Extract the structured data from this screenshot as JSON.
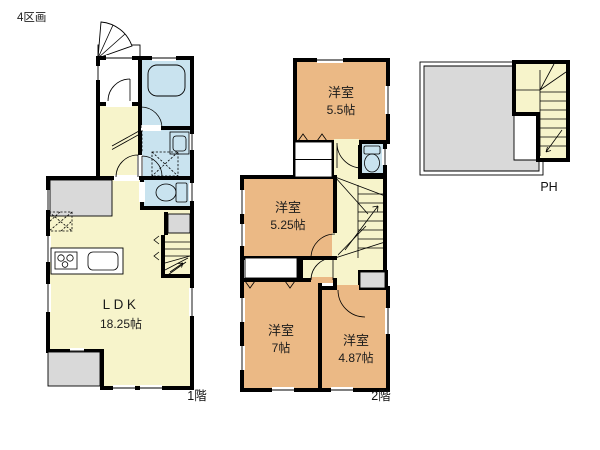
{
  "title": "4区画",
  "floor1": {
    "label": "1階",
    "ldk": {
      "name": "LDK",
      "size": "18.25帖"
    }
  },
  "floor2": {
    "label": "2階",
    "rooms": [
      {
        "name": "洋室",
        "size": "5.5帖"
      },
      {
        "name": "洋室",
        "size": "5.25帖"
      },
      {
        "name": "洋室",
        "size": "7帖"
      },
      {
        "name": "洋室",
        "size": "4.87帖"
      }
    ]
  },
  "ph": {
    "label": "PH"
  },
  "colors": {
    "room": "#EBB985",
    "hall": "#F7F4CB",
    "wet": "#C9E3EF",
    "outdoor": "#D9D9D9",
    "wall": "#000000"
  }
}
